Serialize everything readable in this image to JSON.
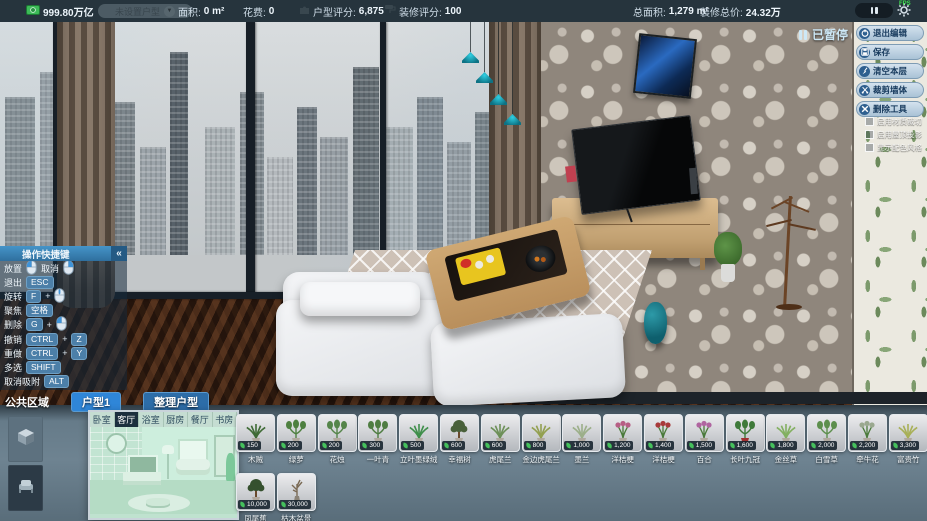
{
  "top_bar": {
    "money": "999.80万亿",
    "house_dropdown": "未设置户型",
    "stats_left": [
      {
        "label": "面积:",
        "value": "0 m²"
      },
      {
        "label": "花费:",
        "value": "0"
      }
    ],
    "scores": [
      {
        "label": "户型评分:",
        "value": "6,875",
        "icon": "puzzle-icon"
      },
      {
        "label": "装修评分:",
        "value": "100",
        "icon": "roller-icon"
      }
    ],
    "stats_right": [
      {
        "label": "总面积:",
        "value": "1,279 m²"
      },
      {
        "label": "装修总价:",
        "value": "24.32万"
      }
    ],
    "fps": "FPS"
  },
  "pause": {
    "paused_label": "已暂停"
  },
  "right_panel": {
    "buttons": [
      {
        "label": "退出编辑",
        "icon": "power-icon"
      },
      {
        "label": "保存",
        "icon": "save-icon"
      },
      {
        "label": "清空本层",
        "icon": "broom-icon"
      },
      {
        "label": "裁剪墙体",
        "icon": "scissors-icon"
      },
      {
        "label": "删除工具",
        "icon": "delete-icon"
      }
    ],
    "checkboxes": [
      {
        "label": "启用材质裁切",
        "checked": false
      },
      {
        "label": "启用屋顶投影",
        "checked": false
      },
      {
        "label": "显示配色风格",
        "checked": false
      }
    ]
  },
  "hotkeys": {
    "title": "操作快捷键",
    "collapse": "«",
    "rows": [
      [
        {
          "label": "放置",
          "keys": [
            {
              "mouse": "left"
            }
          ]
        },
        {
          "label": "取消",
          "keys": [
            {
              "mouse": "right"
            }
          ]
        }
      ],
      [
        {
          "label": "退出",
          "keys": [
            {
              "key": "ESC"
            }
          ]
        }
      ],
      [
        {
          "label": "旋转",
          "keys": [
            {
              "key": "F"
            },
            {
              "plus": true
            },
            {
              "mouse": "mid"
            }
          ]
        }
      ],
      [
        {
          "label": "聚焦",
          "keys": [
            {
              "key": "空格"
            }
          ]
        }
      ],
      [
        {
          "label": "删除",
          "keys": [
            {
              "key": "G"
            },
            {
              "plus": true
            },
            {
              "mouse": "left"
            }
          ]
        }
      ],
      [
        {
          "label": "撤销",
          "keys": [
            {
              "key": "CTRL"
            },
            {
              "plus": true
            },
            {
              "key": "Z"
            }
          ]
        }
      ],
      [
        {
          "label": "重做",
          "keys": [
            {
              "key": "CTRL"
            },
            {
              "plus": true
            },
            {
              "key": "Y"
            }
          ]
        }
      ],
      [
        {
          "label": "多选",
          "keys": [
            {
              "key": "SHIFT"
            }
          ]
        }
      ],
      [
        {
          "label": "取消吸附",
          "keys": [
            {
              "key": "ALT"
            }
          ]
        }
      ]
    ]
  },
  "area_tabs": [
    {
      "label": "公共区域",
      "style": "plain"
    },
    {
      "label": "户型1",
      "style": "active"
    },
    {
      "label": "整理户型",
      "style": "pill"
    }
  ],
  "catalog": {
    "side_buttons": [
      {
        "icon": "build-category-icon",
        "active": true
      },
      {
        "icon": "furniture-category-icon",
        "active": false
      }
    ],
    "room_tabs": [
      "卧室",
      "客厅",
      "浴室",
      "厨房",
      "餐厅",
      "书房"
    ],
    "active_room": "客厅",
    "items_row1": [
      {
        "price": "150",
        "name": "木贼",
        "color": "#3f6b35",
        "shape": "grass"
      },
      {
        "price": "200",
        "name": "绿萝",
        "color": "#4e8040",
        "shape": "leafy"
      },
      {
        "price": "200",
        "name": "花烛",
        "color": "#55854a",
        "shape": "leafy"
      },
      {
        "price": "300",
        "name": "一叶青",
        "color": "#4f7d42",
        "shape": "leafy"
      },
      {
        "price": "500",
        "name": "立叶墨绿绒",
        "color": "#3f8f4a",
        "shape": "grass"
      },
      {
        "price": "600",
        "name": "幸福树",
        "color": "#49603a",
        "shape": "tree"
      },
      {
        "price": "600",
        "name": "虎尾兰",
        "color": "#6d9058",
        "shape": "grass"
      },
      {
        "price": "800",
        "name": "金边虎尾兰",
        "color": "#93a050",
        "shape": "grass"
      },
      {
        "price": "1,000",
        "name": "墨兰",
        "color": "#9caf89",
        "shape": "grass"
      },
      {
        "price": "1,200",
        "name": "洋桔梗",
        "color": "#b75f85",
        "shape": "flower"
      },
      {
        "price": "1,400",
        "name": "洋桔梗",
        "color": "#a83a3a",
        "shape": "flower"
      },
      {
        "price": "1,500",
        "name": "百合",
        "color": "#b065a0",
        "shape": "flower"
      },
      {
        "price": "1,600",
        "name": "长叶九冠",
        "color": "#3f7a3a",
        "shape": "leafy",
        "pot": "#a03030"
      },
      {
        "price": "1,800",
        "name": "金丝草",
        "color": "#83b060",
        "shape": "grass"
      },
      {
        "price": "2,000",
        "name": "白雪草",
        "color": "#5d8f4d",
        "shape": "leafy"
      },
      {
        "price": "2,200",
        "name": "牵牛花",
        "color": "#9aa88f",
        "shape": "flower"
      },
      {
        "price": "3,300",
        "name": "富贵竹",
        "color": "#a8b057",
        "shape": "grass"
      }
    ],
    "items_row2": [
      {
        "price": "10,000",
        "name": "凤尾蕉",
        "color": "#35502e",
        "shape": "tree"
      },
      {
        "price": "30,000",
        "name": "枯木盆景",
        "color": "#7a6a55",
        "shape": "bare"
      }
    ]
  }
}
